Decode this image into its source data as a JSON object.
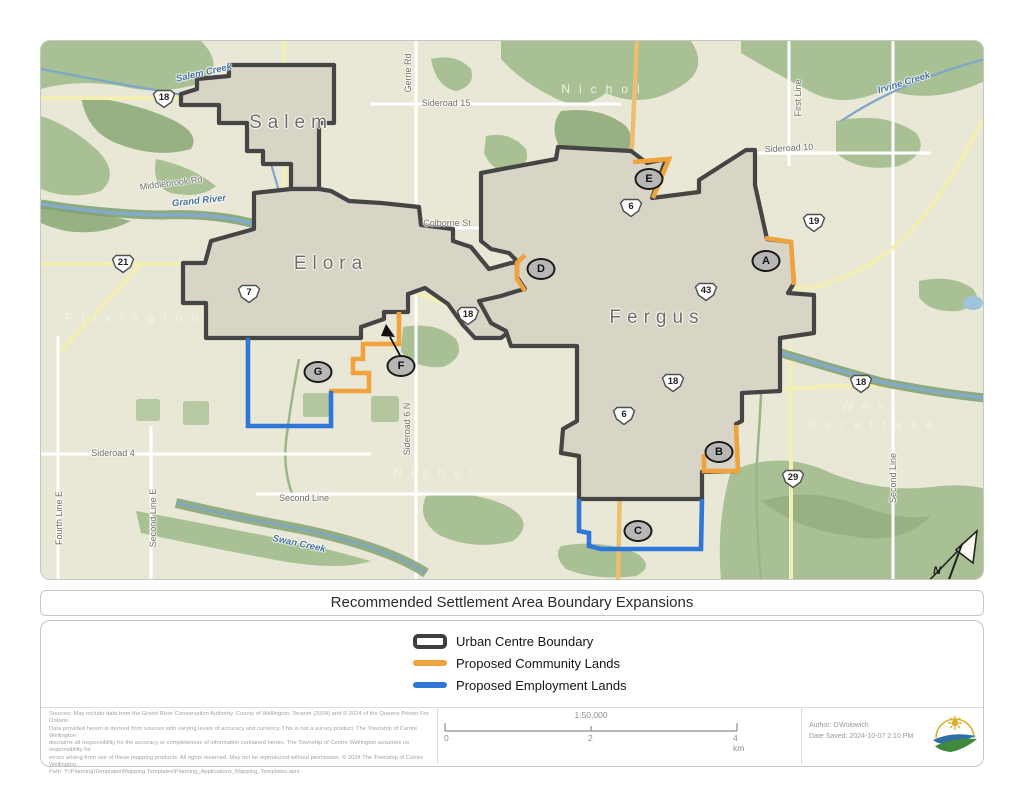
{
  "title": "Recommended Settlement Area Boundary Expansions",
  "legend": {
    "items": [
      {
        "label": "Urban Centre Boundary",
        "color": "#3f3f3f"
      },
      {
        "label": "Proposed Community Lands",
        "color": "#f0a33c"
      },
      {
        "label": "Proposed Employment Lands",
        "color": "#2f76d9"
      }
    ]
  },
  "map": {
    "towns": [
      {
        "name": "Salem"
      },
      {
        "name": "Elora"
      },
      {
        "name": "Fergus"
      }
    ],
    "townships": [
      {
        "name": "Pilkington"
      },
      {
        "name": "Nichol"
      },
      {
        "name": "Nichol"
      },
      {
        "name": "West"
      },
      {
        "name": "Garafraxa"
      }
    ],
    "waterways": [
      {
        "name": "Salem Creek"
      },
      {
        "name": "Grand River"
      },
      {
        "name": "Irvine Creek"
      },
      {
        "name": "Swan Creek"
      }
    ],
    "roads": [
      {
        "name": "Middlebrook Rd"
      },
      {
        "name": "Gerrie Rd"
      },
      {
        "name": "Sideroad 15"
      },
      {
        "name": "Colborne St"
      },
      {
        "name": "First Line"
      },
      {
        "name": "Sideroad 10"
      },
      {
        "name": "Sideroad 6 N"
      },
      {
        "name": "Second Line"
      },
      {
        "name": "Sideroad 4"
      },
      {
        "name": "Fourth Line E"
      },
      {
        "name": "Second Line E"
      },
      {
        "name": "Second Line"
      }
    ],
    "highway_shields": [
      {
        "number": "18"
      },
      {
        "number": "21"
      },
      {
        "number": "7"
      },
      {
        "number": "18"
      },
      {
        "number": "6"
      },
      {
        "number": "19"
      },
      {
        "number": "43"
      },
      {
        "number": "18"
      },
      {
        "number": "6"
      },
      {
        "number": "18"
      },
      {
        "number": "29"
      }
    ],
    "expansion_markers": [
      {
        "letter": "A"
      },
      {
        "letter": "B"
      },
      {
        "letter": "C"
      },
      {
        "letter": "D"
      },
      {
        "letter": "E"
      },
      {
        "letter": "F"
      },
      {
        "letter": "G"
      }
    ],
    "north_label": "N"
  },
  "footer": {
    "sources_lines": [
      "Sources: May include data from the Grand River Conservation Authority, County of Wellington, Teranet (2004) and © 2024 of the Queens Printer For Ontario.",
      "Data provided herein is derived from sources with varying levels of accuracy and currency. This is not a survey product. The Township of Centre Wellington",
      "disclaims all responsibility for the accuracy or completeness of information contained herein. The Township of Centre Wellington assumes no responsibility for",
      "errors arising from use of these mapping products. All rights reserved. May not be reproduced without permission. © 2024 The Township of Centre Wellington.",
      "Path: Y:\\Planning\\Templates\\Mapping Templates\\Planning_Applications_Mapping_Templates.aprx"
    ],
    "scale": {
      "ratio": "1:50,000",
      "tick_start": "0",
      "tick_mid": "2",
      "tick_end": "4 km"
    },
    "author": "Author: GWolowich",
    "date_saved": "Date Saved: 2024-10-07 2:10 PM"
  }
}
